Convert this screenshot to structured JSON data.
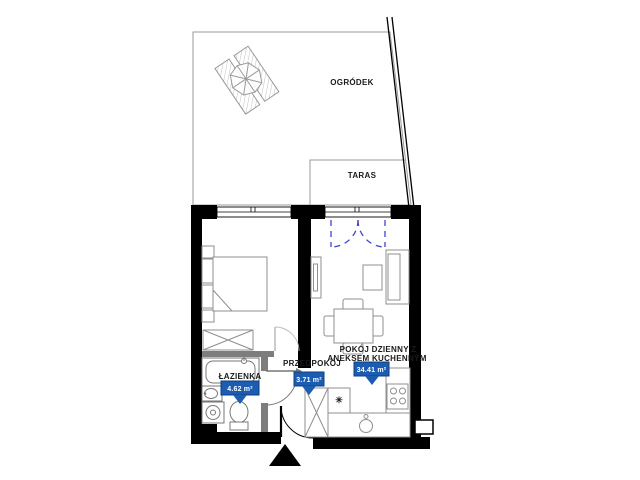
{
  "plan_title": "apartment-floor-plan",
  "rooms": {
    "garden": {
      "label": "OGRÓDEK"
    },
    "terrace": {
      "label": "TARAS"
    },
    "bathroom": {
      "label": "ŁAZIENKA",
      "area": "4.62 m²"
    },
    "hallway": {
      "label": "PRZEDPOKÓJ",
      "area": "3.71 m²"
    },
    "living_room": {
      "label_line1": "POKÓJ DZIENNY Z",
      "label_line2": "ANEKSEM KUCHENNYM",
      "area": "34.41 m²"
    }
  },
  "colors": {
    "badge_fill": "#1c5db1",
    "badge_border": "#0d3f85",
    "badge_text": "#ffffff",
    "door_swing_dashed": "#3c46c8",
    "wall": "#000000",
    "partition": "#7d7d7d",
    "furniture": "#8f8f8f"
  },
  "icons": {
    "fridge_snowflake": "✳"
  }
}
